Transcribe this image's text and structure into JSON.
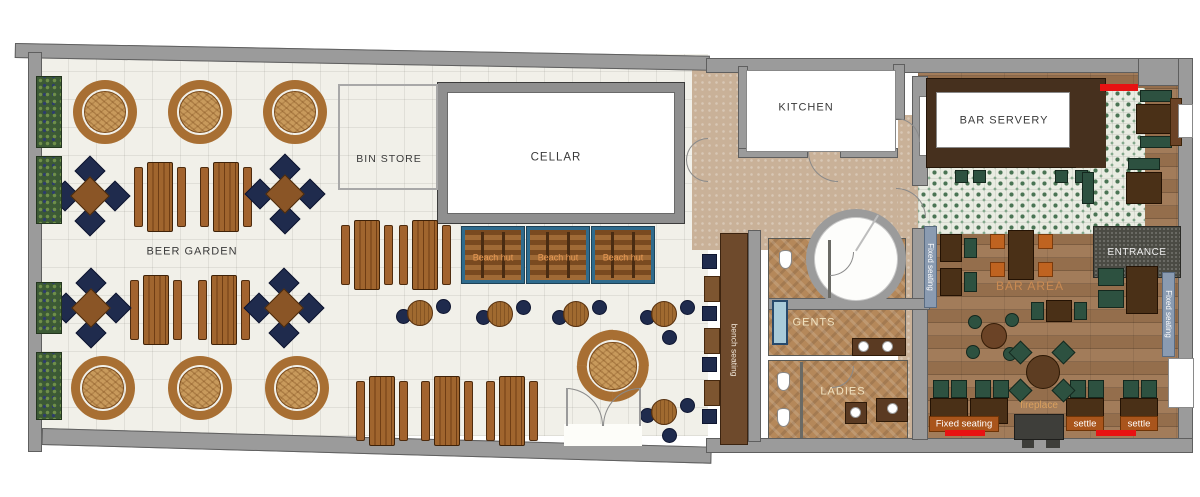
{
  "labels": {
    "beer_garden": "BEER GARDEN",
    "bin_store": "BIN STORE",
    "cellar": "CELLAR",
    "kitchen": "KITCHEN",
    "bar_servery": "BAR SERVERY",
    "bar_area": "BAR AREA",
    "entrance": "ENTRANCE",
    "gents": "GENTS",
    "ladies": "LADIES",
    "bench_seating": "bench seating",
    "beach_hut_1": "Beach hut",
    "beach_hut_2": "Beach hut",
    "beach_hut_3": "Beach hut",
    "fixed_seating_left": "Fixed seating",
    "fixed_seating_right": "Fixed seating",
    "fixed_seating_bottom": "Fixed seating",
    "settle_1": "settle",
    "settle_2": "settle",
    "fireplace": "fireplace"
  },
  "colors": {
    "wall_gray": "#9b9b9b",
    "garden_floor": "#f1f0e9",
    "corridor_tan": "#c9b198",
    "wc_floor": "#b5885a",
    "wood_floor": "#9c7450",
    "tile_base": "#e9ece2",
    "tile_green": "#4a7454",
    "navy_seat": "#1f2b4d",
    "green_seat": "#2d5140",
    "picnic_wood": "#9c5c28",
    "rattan_table": "#c89a5c",
    "curved_bench": "#a86f33",
    "beach_hut_blue": "#2f6b8d",
    "label_orange_bg": "#a9551c",
    "accent_red": "#e81212",
    "seatback_blue": "#8a9bb1",
    "entrance_mat": "#4b4b44",
    "hut_label_orange": "#e89a55",
    "bar_area_label": "#c98a52",
    "fireplace_label": "#daa05e"
  },
  "furniture": {
    "round_tables": [
      [
        105,
        112,
        1
      ],
      [
        200,
        112,
        1
      ],
      [
        295,
        112,
        1
      ],
      [
        103,
        388,
        1
      ],
      [
        200,
        388,
        1
      ],
      [
        297,
        388,
        1
      ],
      [
        613,
        366,
        1.12
      ]
    ],
    "picnic_tables": [
      [
        160,
        197
      ],
      [
        226,
        197
      ],
      [
        156,
        310
      ],
      [
        224,
        310
      ],
      [
        367,
        255
      ],
      [
        425,
        255
      ],
      [
        382,
        411
      ],
      [
        447,
        411
      ],
      [
        512,
        411
      ]
    ],
    "square_tables": [
      [
        90,
        196
      ],
      [
        285,
        194
      ],
      [
        91,
        308
      ],
      [
        284,
        308
      ]
    ],
    "poseur_tables": [
      [
        420,
        313,
        2
      ],
      [
        500,
        314,
        2
      ],
      [
        576,
        314,
        2
      ],
      [
        664,
        314,
        3
      ],
      [
        664,
        412,
        3
      ]
    ],
    "planters": [
      [
        36,
        76,
        72
      ],
      [
        36,
        156,
        68
      ],
      [
        36,
        282,
        52
      ],
      [
        36,
        352,
        68
      ]
    ],
    "bench_stools_y": [
      254,
      306,
      357,
      409
    ],
    "bench_blocks_y": [
      276,
      328,
      380
    ],
    "bar_stools": [
      [
        955,
        170
      ],
      [
        973,
        170
      ],
      [
        1055,
        170
      ],
      [
        1075,
        170
      ]
    ],
    "booth_seats": [
      [
        933,
        380
      ],
      [
        951,
        380
      ],
      [
        975,
        380
      ],
      [
        993,
        380
      ],
      [
        1070,
        380
      ],
      [
        1088,
        380
      ],
      [
        1123,
        380
      ],
      [
        1141,
        380
      ]
    ],
    "booth_tables": [
      [
        930,
        398
      ],
      [
        970,
        398
      ],
      [
        1066,
        398
      ],
      [
        1120,
        398
      ]
    ]
  }
}
